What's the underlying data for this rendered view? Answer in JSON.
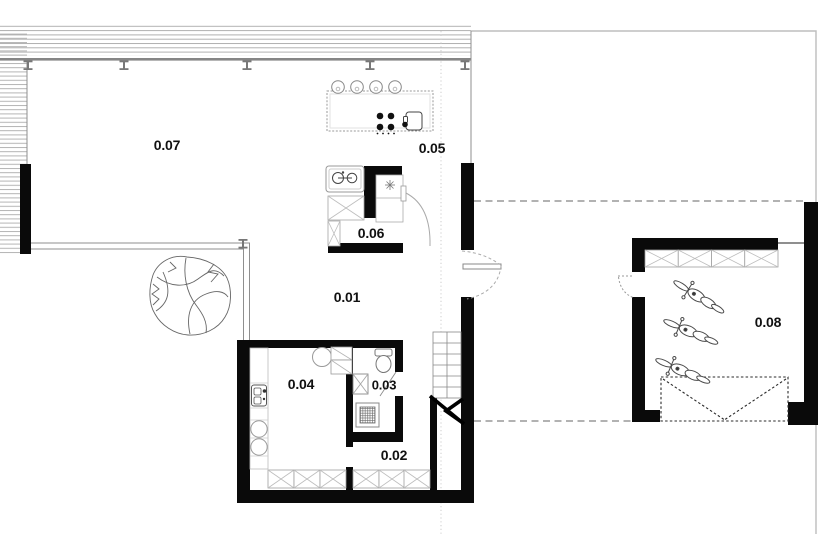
{
  "drawing": {
    "kind": "floor-plan"
  },
  "rooms": {
    "r07": {
      "label": "0.07"
    },
    "r05": {
      "label": "0.05"
    },
    "r06": {
      "label": "0.06"
    },
    "r01": {
      "label": "0.01"
    },
    "r04": {
      "label": "0.04"
    },
    "r03": {
      "label": "0.03"
    },
    "r02": {
      "label": "0.02"
    },
    "r08": {
      "label": "0.08"
    }
  },
  "colors": {
    "wall": "#0a0a0a",
    "thin_line": "#9a9a9a",
    "hatch": "#b4b4b4",
    "dashed_outline": "#8c8c8c",
    "label_text": "#111111",
    "background": "#ffffff"
  },
  "symbols": [
    "tree-icon",
    "motorcycle-icon",
    "bar-stool-icon",
    "cooktop-icon",
    "sink-icon",
    "toilet-icon",
    "shower-icon",
    "washing-machine-icon",
    "stairs-icon",
    "door-swing-icon",
    "garage-door-icon",
    "steel-column-icon",
    "wardrobe-icon"
  ]
}
